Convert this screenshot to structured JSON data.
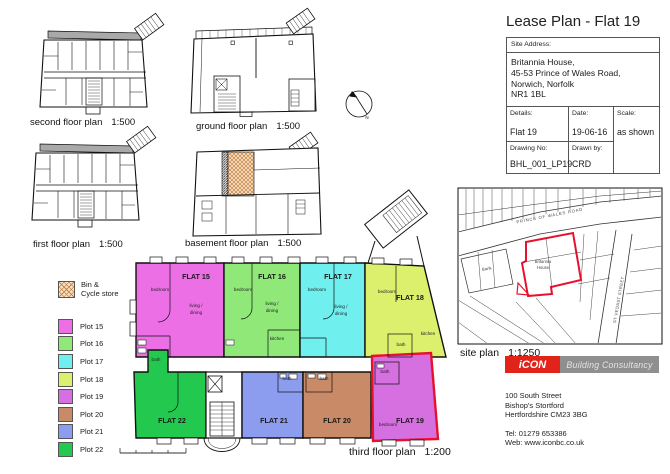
{
  "title": "Lease Plan - Flat 19",
  "title_block": {
    "site_address_label": "Site Address:",
    "address_lines": [
      "Britannia House,",
      "45-53 Prince of Wales Road,",
      "Norwich, Norfolk",
      "NR1 1BL"
    ],
    "details_label": "Details:",
    "details_value": "Flat 19",
    "date_label": "Date:",
    "date_value": "19-06-16",
    "scale_label": "Scale:",
    "scale_value": "as shown",
    "drawing_no_label": "Drawing No:",
    "drawing_no_value": "BHL_001_LP19",
    "drawn_by_label": "Drawn by:",
    "drawn_by_value": "CRD"
  },
  "plans": {
    "second": {
      "caption": "second floor plan",
      "scale": "1:500"
    },
    "ground": {
      "caption": "ground floor plan",
      "scale": "1:500"
    },
    "first": {
      "caption": "first floor plan",
      "scale": "1:500"
    },
    "basement": {
      "caption": "basement floor plan",
      "scale": "1:500"
    },
    "third": {
      "caption": "third floor plan",
      "scale": "1:200"
    },
    "site": {
      "caption": "site plan",
      "scale": "1:1250"
    }
  },
  "legend": {
    "bin_label_1": "Bin &",
    "bin_label_2": "Cycle store",
    "plots": [
      {
        "label": "Plot 15",
        "color": "#ec6fe6"
      },
      {
        "label": "Plot 16",
        "color": "#8fe878"
      },
      {
        "label": "Plot 17",
        "color": "#70efef"
      },
      {
        "label": "Plot 18",
        "color": "#ddf06e"
      },
      {
        "label": "Plot 19",
        "color": "#d66fe0"
      },
      {
        "label": "Plot 20",
        "color": "#c98a68"
      },
      {
        "label": "Plot 21",
        "color": "#8c9cee"
      },
      {
        "label": "Plot 22",
        "color": "#22c94e"
      }
    ]
  },
  "flats": [
    {
      "name": "FLAT 15",
      "color": "#ec6fe6"
    },
    {
      "name": "FLAT 16",
      "color": "#8fe878"
    },
    {
      "name": "FLAT 17",
      "color": "#70efef"
    },
    {
      "name": "FLAT 18",
      "color": "#ddf06e"
    },
    {
      "name": "FLAT 19",
      "color": "#d66fe0"
    },
    {
      "name": "FLAT 20",
      "color": "#c98a68"
    },
    {
      "name": "FLAT 21",
      "color": "#8c9cee"
    },
    {
      "name": "FLAT 22",
      "color": "#22c94e"
    }
  ],
  "rooms": {
    "bedroom": "bedroom",
    "living1": "living /",
    "living2": "dining",
    "kitchen": "kitchen",
    "bath": "bath"
  },
  "north": {
    "label": "N"
  },
  "site_map": {
    "road1": "PRINCE OF WALES ROAD",
    "road2": "ST VEDAST STREET",
    "building1": "Britannia",
    "building2": "House",
    "bank": "Bank"
  },
  "logo": {
    "name": "iCON",
    "suffix": "Building Consultancy",
    "red": "#e2231a",
    "gray": "#8f8f8f"
  },
  "firm": {
    "address": [
      "100 South Street",
      "Bishop's Stortford",
      "Hertfordshire CM23 3BG"
    ],
    "tel": "Tel: 01279 653386",
    "web": "Web: www.iconbc.co.uk"
  },
  "colors": {
    "outline_red": "#e8112d"
  }
}
